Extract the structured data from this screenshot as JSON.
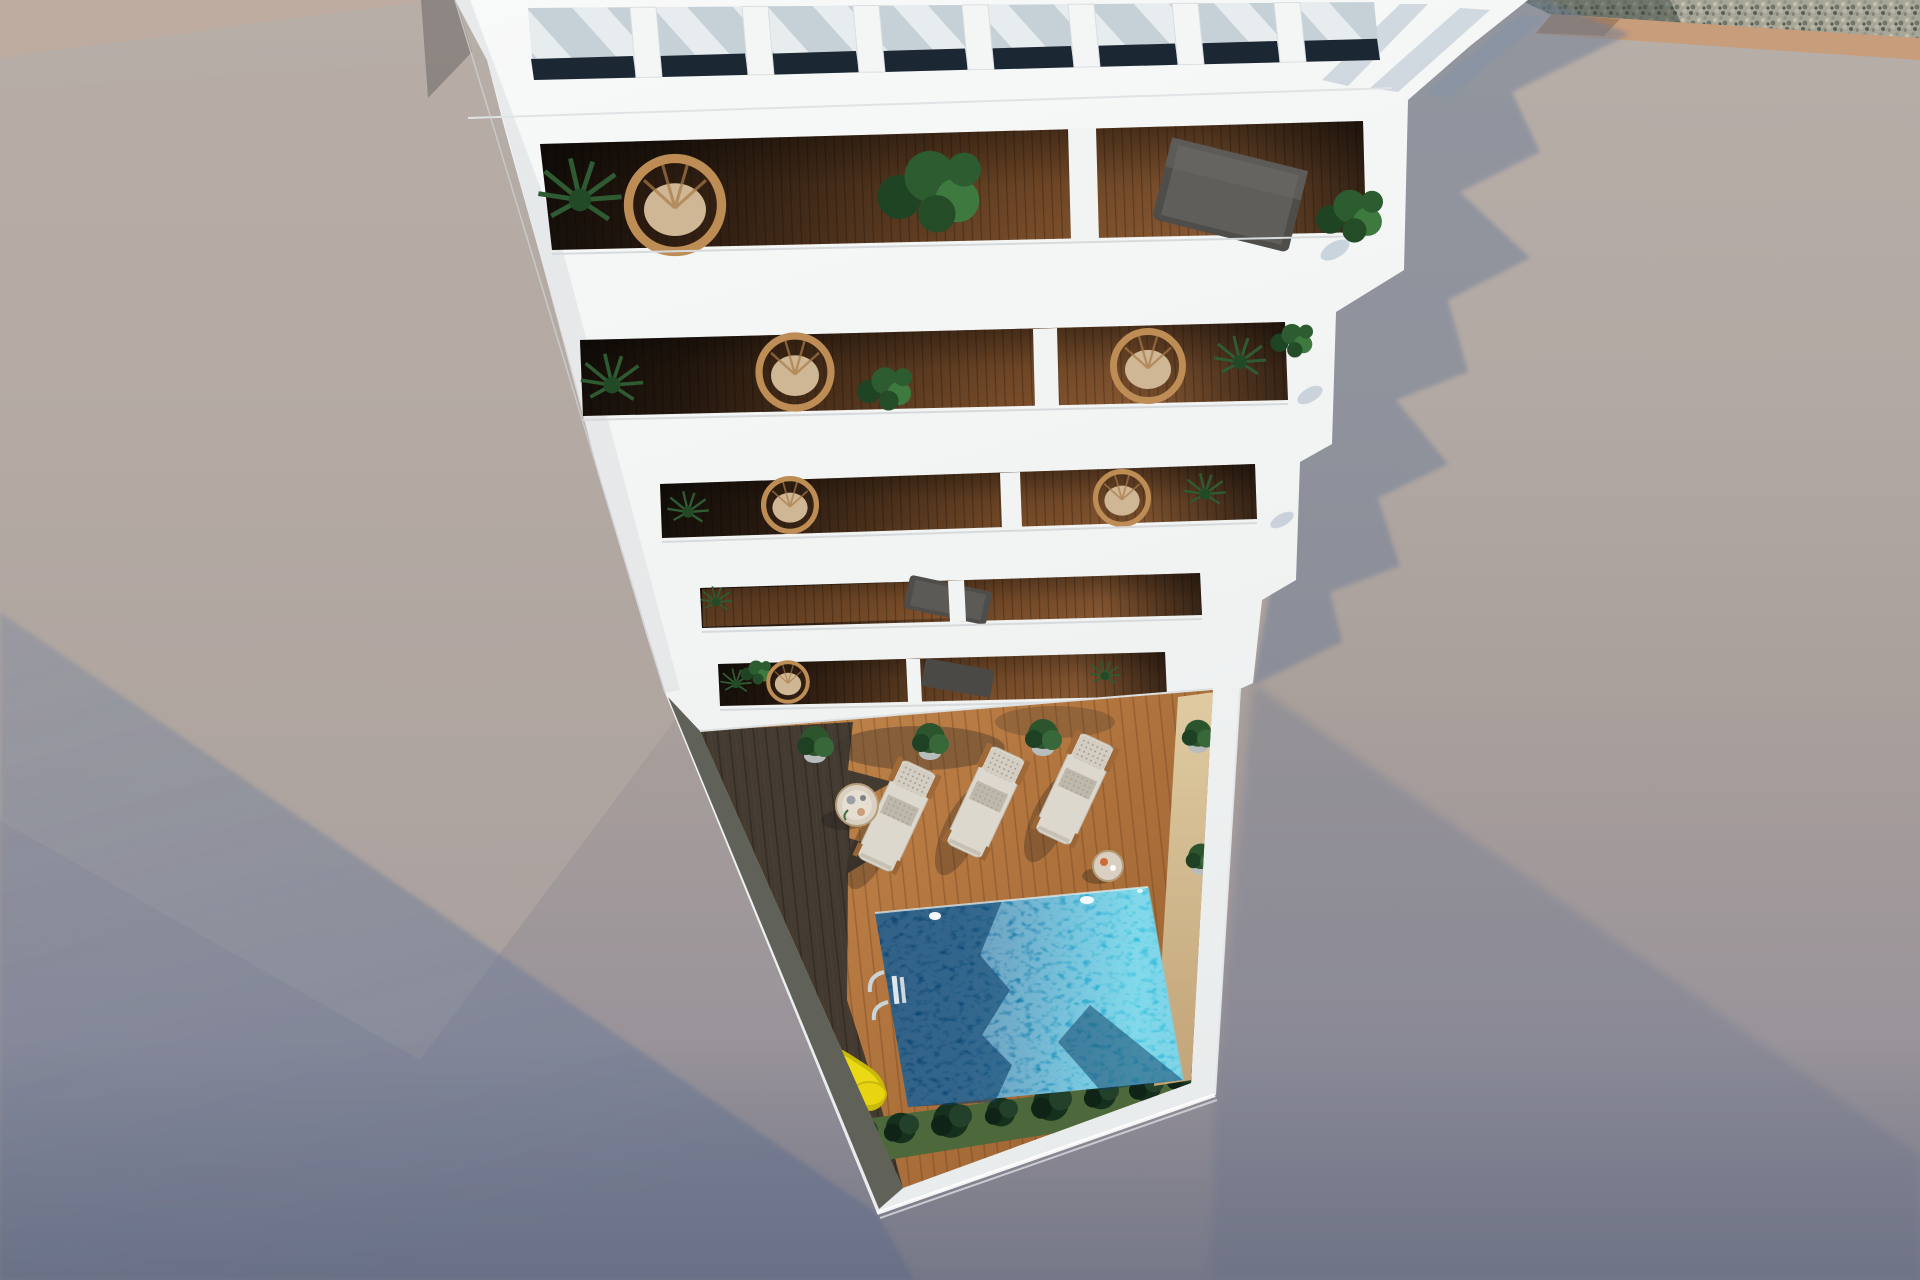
{
  "scene": {
    "title": "Aerial 3D render of a white apartment building with tiered balconies above a pool courtyard",
    "view": "top-down aerial, sunny daylight with hard cast shadows"
  },
  "palette": {
    "concrete_lit": "#b3a9a4",
    "concrete_shadow": "#8c95a6",
    "building_white": "#f4f5f5",
    "balcony_wood_dark": "#27190f",
    "balcony_wood_lit": "#8a5a33",
    "deck_wood_lit": "#b47740",
    "deck_wood_shadow": "#3b362f",
    "pool_deep": "#0d4a79",
    "pool_bright": "#2fc0dd",
    "grass": "#4d683b",
    "bush_green": "#16301e",
    "gravel": "#a7a699",
    "kerb_tan": "#c79d7c",
    "slide_yellow": "#e8d410",
    "playground_red": "#c24a30",
    "platform_pink": "#b2616b",
    "lounger_cream": "#ddd8ce",
    "wicker_tan": "#bd8d55",
    "plant_green": "#2c552e",
    "glazing_dark": "#1b2733"
  },
  "building": {
    "pergola_openings": 8,
    "balcony_floors": 5,
    "units_per_floor": 2
  },
  "courtyard": {
    "sun_loungers": 3,
    "side_tables": 2,
    "potted_plants": 6,
    "bushes_row": true,
    "pool": {
      "shape": "rectangular",
      "ladder": true
    },
    "playground": {
      "slide": true,
      "gym_frame": true,
      "platform": true
    },
    "outdoor_shower": true
  }
}
